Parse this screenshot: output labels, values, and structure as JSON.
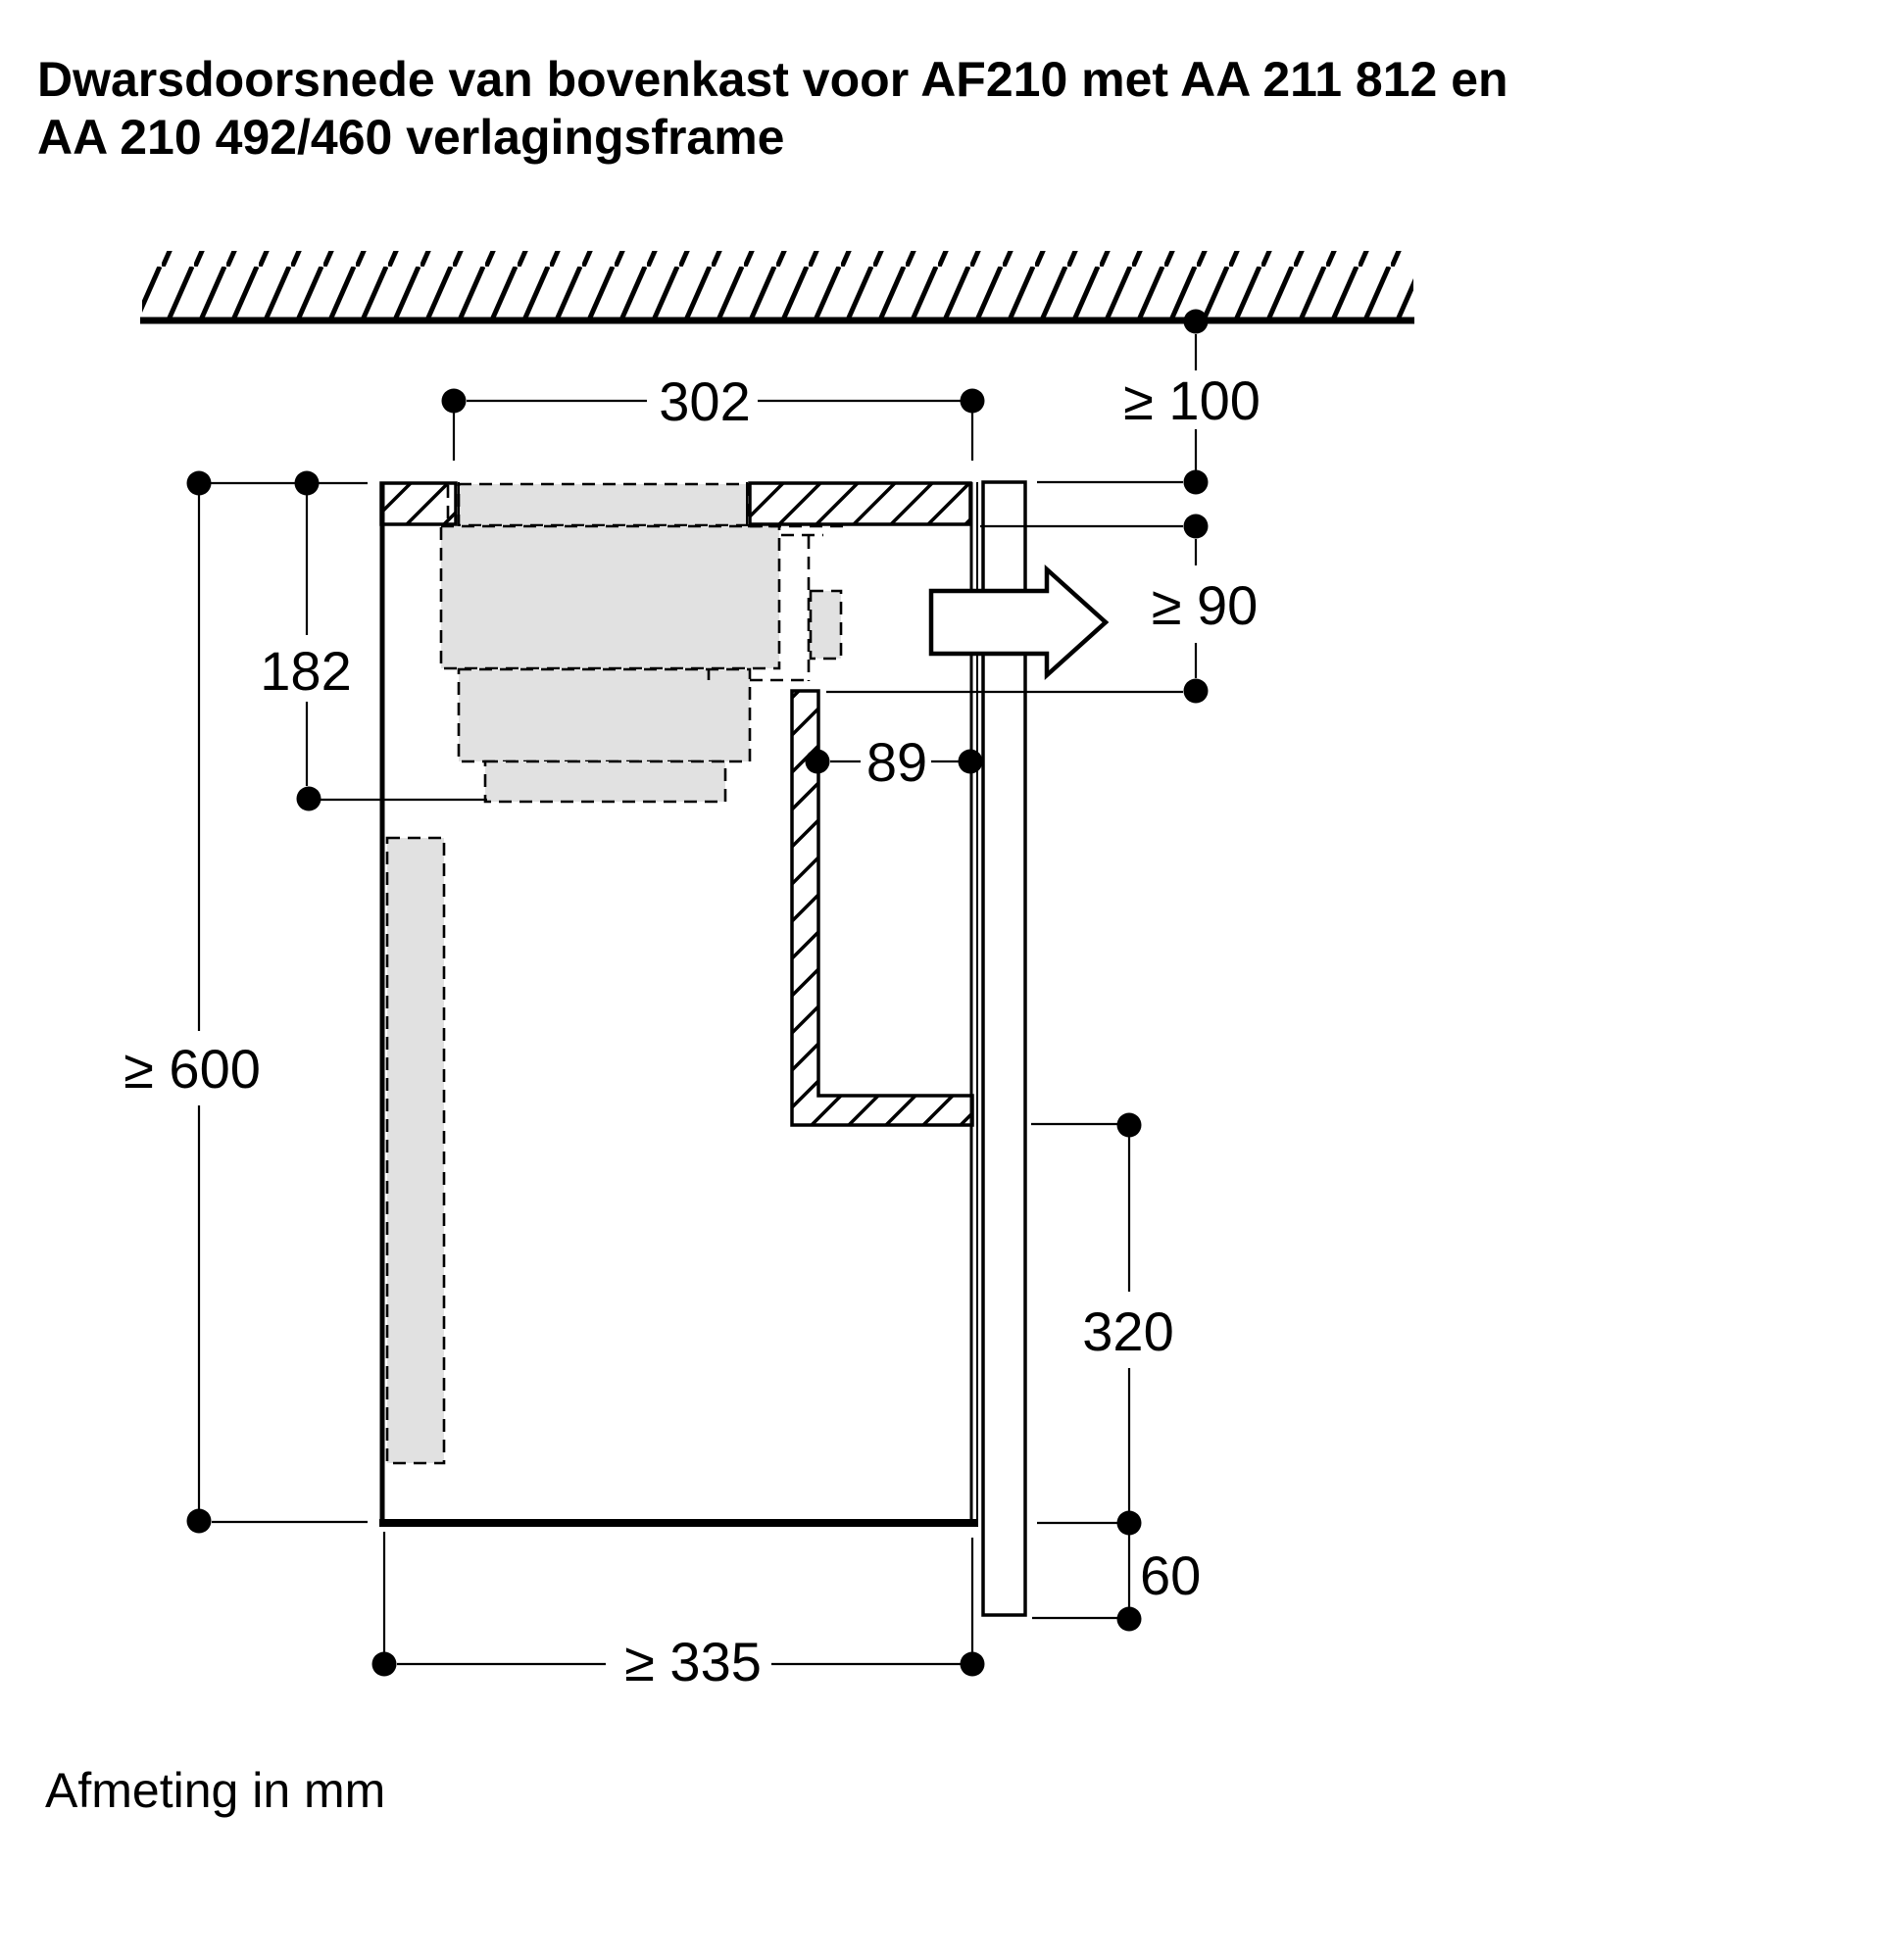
{
  "title": {
    "line1": "Dwarsdoorsnede van bovenkast voor AF210 met AA 211 812 en",
    "line2": "AA 210 492/460 verlagingsframe"
  },
  "footer": {
    "note": "Afmeting in mm"
  },
  "diagram": {
    "unit": "mm",
    "dimensions": {
      "top_width": "302",
      "ceiling_clearance": "≥ 100",
      "hood_height": "182",
      "outlet_clearance": "≥ 90",
      "duct_offset": "89",
      "cabinet_height": "≥ 600",
      "duct_to_bottom": "320",
      "panel_overhang": "60",
      "cabinet_depth": "≥ 335"
    },
    "colors": {
      "appliance_fill_gray": "#e1e1e1",
      "line_black": "#000000",
      "background": "#ffffff"
    }
  }
}
